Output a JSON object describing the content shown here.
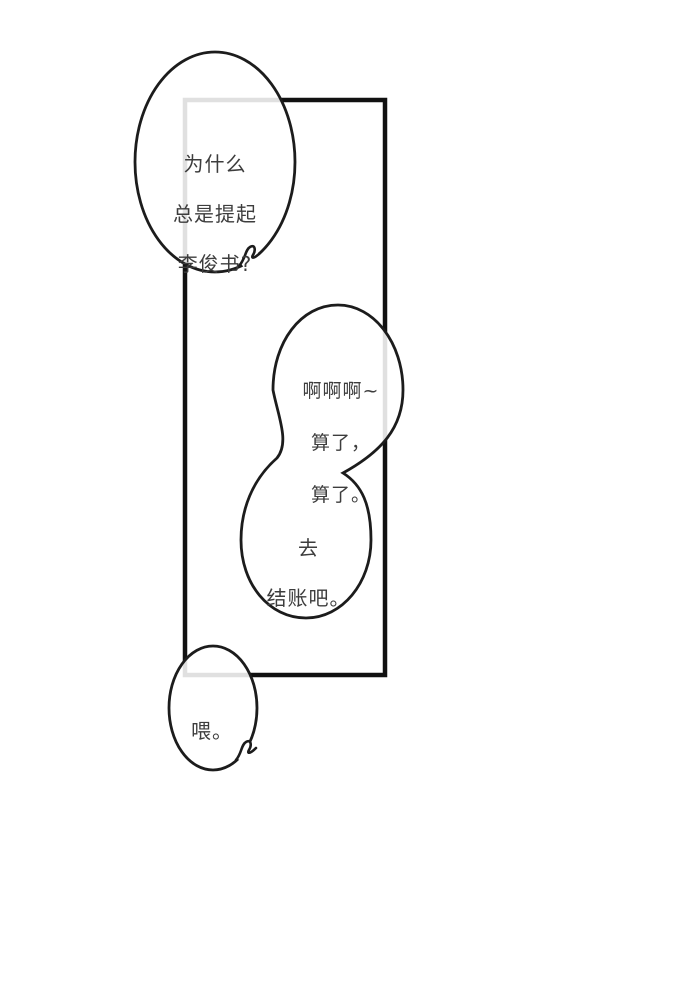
{
  "page": {
    "type": "comic-page",
    "background_color": "#ffffff",
    "line_color": "#1c1c1c",
    "panel_border_color": "#111111",
    "text_color": "#3d3d3d"
  },
  "panel": {
    "description": "tall rectangular comic panel frame"
  },
  "bubbles": [
    {
      "id": "bubble-1",
      "lines": [
        "为什么",
        "总是提起",
        "李俊书?"
      ]
    },
    {
      "id": "bubble-2",
      "lines": [
        "啊啊啊~",
        "算了，",
        "算了。"
      ]
    },
    {
      "id": "bubble-3",
      "lines": [
        "去",
        "结账吧。"
      ]
    },
    {
      "id": "bubble-4",
      "lines": [
        "喂。"
      ]
    }
  ]
}
